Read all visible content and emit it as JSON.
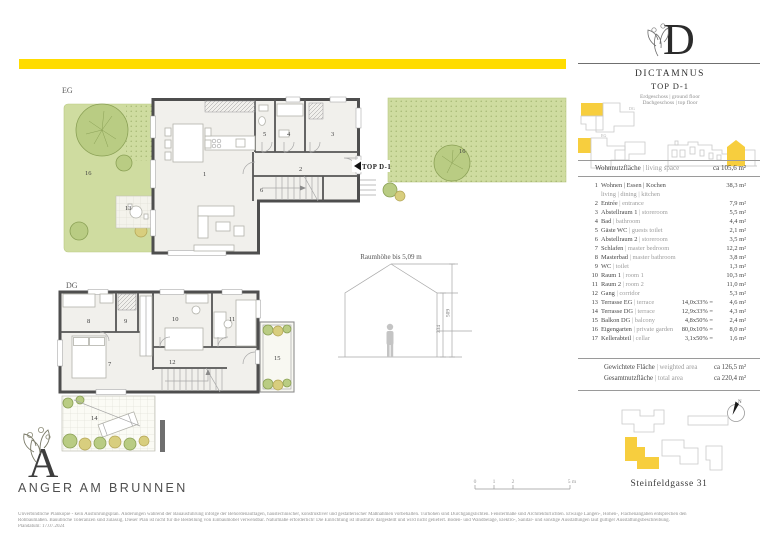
{
  "colors": {
    "bar": "#ffdc00",
    "accent": "#f7ce3e",
    "garden": "#cfdca0"
  },
  "header": {
    "monogram": "D",
    "name": "DICTAMNUS",
    "top": "TOP D-1",
    "floor1": "Erdgeschoss | ground floor",
    "floor2": "Dachgeschoss | top floor"
  },
  "living": {
    "de": "Wohnnutzfläche",
    "en": " | living space",
    "value": "ca 105,6 m²"
  },
  "rooms": [
    {
      "nr": "1",
      "de": "Wohnen | Essen | Kochen",
      "en": "",
      "sub": "living | dining | kitchen",
      "calc": "",
      "area": "38,3 m²"
    },
    {
      "nr": "2",
      "de": "Entrée",
      "en": " | entrance",
      "calc": "",
      "area": "7,9 m²"
    },
    {
      "nr": "3",
      "de": "Abstellraum 1",
      "en": " | storeroom",
      "calc": "",
      "area": "5,5 m²"
    },
    {
      "nr": "4",
      "de": "Bad",
      "en": " | bathroom",
      "calc": "",
      "area": "4,4 m²"
    },
    {
      "nr": "5",
      "de": "Gäste WC",
      "en": " | guests toilet",
      "calc": "",
      "area": "2,1 m²"
    },
    {
      "nr": "6",
      "de": "Abstellraum 2",
      "en": " | storeroom",
      "calc": "",
      "area": "3,5 m²"
    },
    {
      "nr": "7",
      "de": "Schlafen",
      "en": " | master bedroom",
      "calc": "",
      "area": "12,2 m²"
    },
    {
      "nr": "8",
      "de": "Masterbad",
      "en": " | master bathroom",
      "calc": "",
      "area": "3,8 m²"
    },
    {
      "nr": "9",
      "de": "WC",
      "en": " | toilet",
      "calc": "",
      "area": "1,3 m²"
    },
    {
      "nr": "10",
      "de": "Raum 1",
      "en": " | room 1",
      "calc": "",
      "area": "10,3 m²"
    },
    {
      "nr": "11",
      "de": "Raum 2",
      "en": " | room 2",
      "calc": "",
      "area": "11,0 m²"
    },
    {
      "nr": "12",
      "de": "Gang",
      "en": " | corridor",
      "calc": "",
      "area": "5,3 m²"
    },
    {
      "nr": "13",
      "de": "Terrasse EG",
      "en": " | terrace",
      "calc": "14,0x33% =",
      "area": "4,6 m²"
    },
    {
      "nr": "14",
      "de": "Terrasse DG",
      "en": " | terrace",
      "calc": "12,9x33% =",
      "area": "4,3 m²"
    },
    {
      "nr": "15",
      "de": "Balkon DG",
      "en": " | balcony",
      "calc": "4,8x50% =",
      "area": "2,4 m²"
    },
    {
      "nr": "16",
      "de": "Eigengarten",
      "en": " | private garden",
      "calc": "80,0x10% =",
      "area": "8,0 m²"
    },
    {
      "nr": "17",
      "de": "Kellerabteil",
      "en": " | cellar",
      "calc": "3,1x50% =",
      "area": "1,6 m²"
    }
  ],
  "totals": {
    "weighted": {
      "de": "Gewichtete Fläche",
      "en": " | weighted area",
      "value": "ca 126,5 m²"
    },
    "total": {
      "de": "Gesamtnutzfläche",
      "en": " | total area",
      "value": "ca 220,4 m²"
    }
  },
  "site": {
    "address": "Steinfeldgasse 31",
    "compass": "N"
  },
  "brand": {
    "monogram": "A",
    "name": "ANGER AM BRUNNEN"
  },
  "plan": {
    "eg_label": "EG",
    "dg_label": "DG",
    "top_label": "TOP D-1",
    "section": {
      "note": "Raumhöhe bis 5,09 m",
      "dim_eaves": "334",
      "dim_ridge": "509"
    },
    "scale": [
      "0",
      "1",
      "2",
      "5 m"
    ]
  },
  "disclaimer": {
    "line1": "Unverbindliche Plankopie - kein Ausführungsplan. Änderungen während der Bauausführung infolge der Behördenauflagen, haustechnischer, konstruktiver und gestalterischer Maßnahmen vorbehalten. Türhöhen sind Durchgangslichten. Fenstermaße sind Architekturlichten. Etwaige Längen-, Höhen-, Flächenangaben entsprechen den",
    "line2": "Rohbaumaßen. Bauübliche Toleranzen sind zulässig. Dieser Plan ist nicht für die Bestellung von Einbaumöbel verwendbar. Naturmaße erforderlich! Die Einrichtung ist illustrativ dargestellt und wird nicht geliefert. Boden- und Wandbeläge, Elektro-, Sanitär- und sonstige Ausstattungen laut gültiger Ausstattungsbeschreibung.",
    "line3": "Plandatum: 17.07.2024"
  }
}
